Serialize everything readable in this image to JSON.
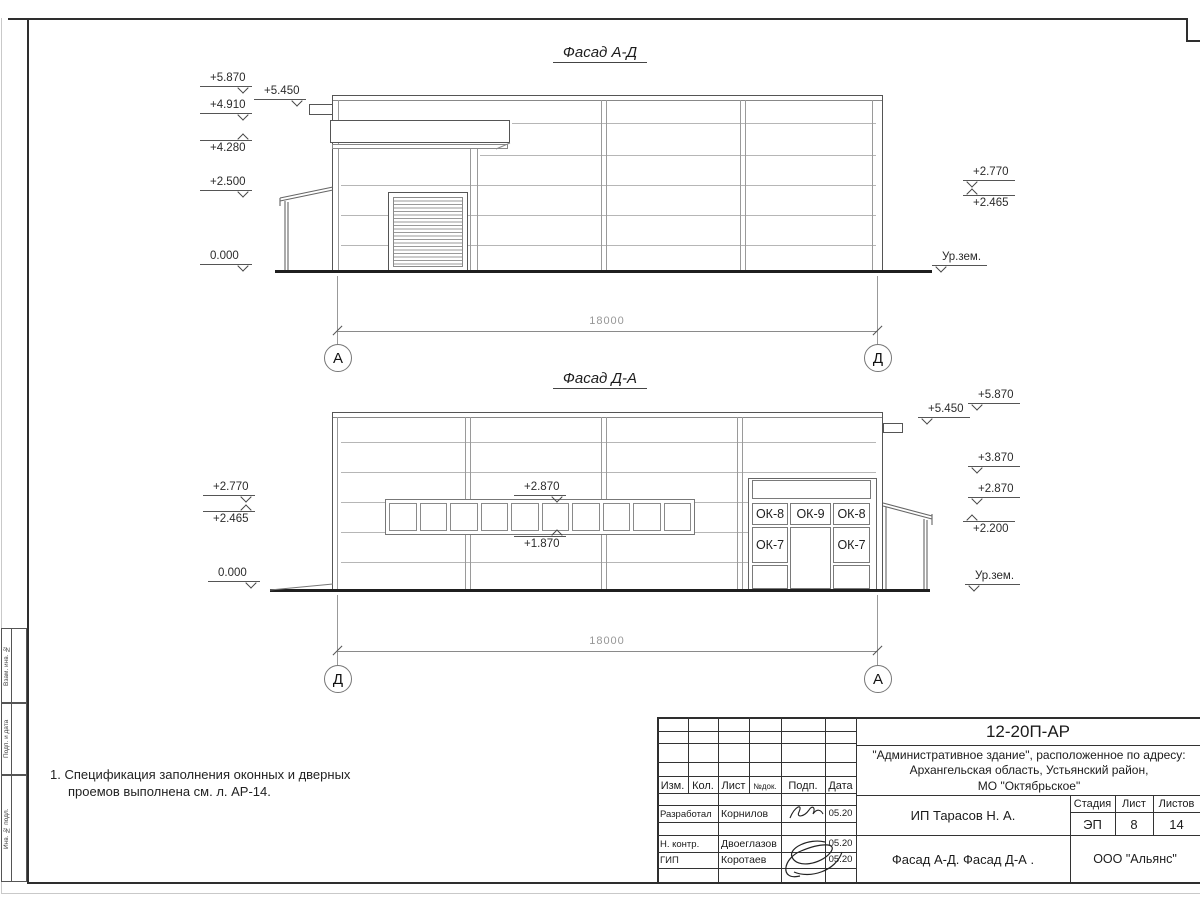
{
  "colors": {
    "ink": "#555555",
    "panel_line": "#b6b6b6",
    "ground": "#1f1f1f",
    "dim_text": "#979797"
  },
  "facade1": {
    "title": "Фасад А-Д",
    "marks_left": [
      "+5.870",
      "+4.910",
      "+4.280",
      "+2.500",
      "0.000"
    ],
    "mark_high": "+5.450",
    "marks_right": [
      "+2.770",
      "+2.465",
      "Ур.зем."
    ],
    "dim": "18000",
    "axis_left": "А",
    "axis_right": "Д"
  },
  "facade2": {
    "title": "Фасад Д-А",
    "marks_left": [
      "+2.770",
      "+2.465",
      "0.000"
    ],
    "band_top": "+2.870",
    "band_bottom": "+1.870",
    "marks_right": [
      "+5.870",
      "+5.450",
      "+3.870",
      "+2.870",
      "+2.200",
      "Ур.зем."
    ],
    "ok8": "ОК-8",
    "ok9": "ОК-9",
    "ok7": "ОК-7",
    "dim": "18000",
    "axis_left": "Д",
    "axis_right": "А"
  },
  "note": {
    "line1": "1. Спецификация заполнения оконных и дверных",
    "line2": "проемов выполнена см. л. АР-14."
  },
  "tb": {
    "doc_number": "12-20П-АР",
    "project1": "\"Административное здание\", расположенное по адресу:",
    "project2": "Архангельская область, Устьянский район,",
    "project3": "МО \"Октябрьское\"",
    "h_izm": "Изм.",
    "h_kol": "Кол.",
    "h_list": "Лист",
    "h_ndok": "№док.",
    "h_podp": "Подп.",
    "h_data": "Дата",
    "rows": [
      {
        "role": "Разработал",
        "name": "Корнилов",
        "date": "05.20"
      },
      {
        "role": "Н. контр.",
        "name": "Двоеглазов",
        "date": "05.20"
      },
      {
        "role": "ГИП",
        "name": "Коротаев",
        "date": "05.20"
      }
    ],
    "client": "ИП Тарасов Н. А.",
    "st_stage": "Стадия",
    "st_list": "Лист",
    "st_listov": "Листов",
    "v_stage": "ЭП",
    "v_list": "8",
    "v_listov": "14",
    "sheet_title": "Фасад А-Д. Фасад Д-А .",
    "company": "ООО \"Альянс\""
  },
  "side": [
    {
      "label": "Взам. инв. №"
    },
    {
      "label": "Подп. и дата"
    },
    {
      "label": "Инв. № подл."
    }
  ]
}
